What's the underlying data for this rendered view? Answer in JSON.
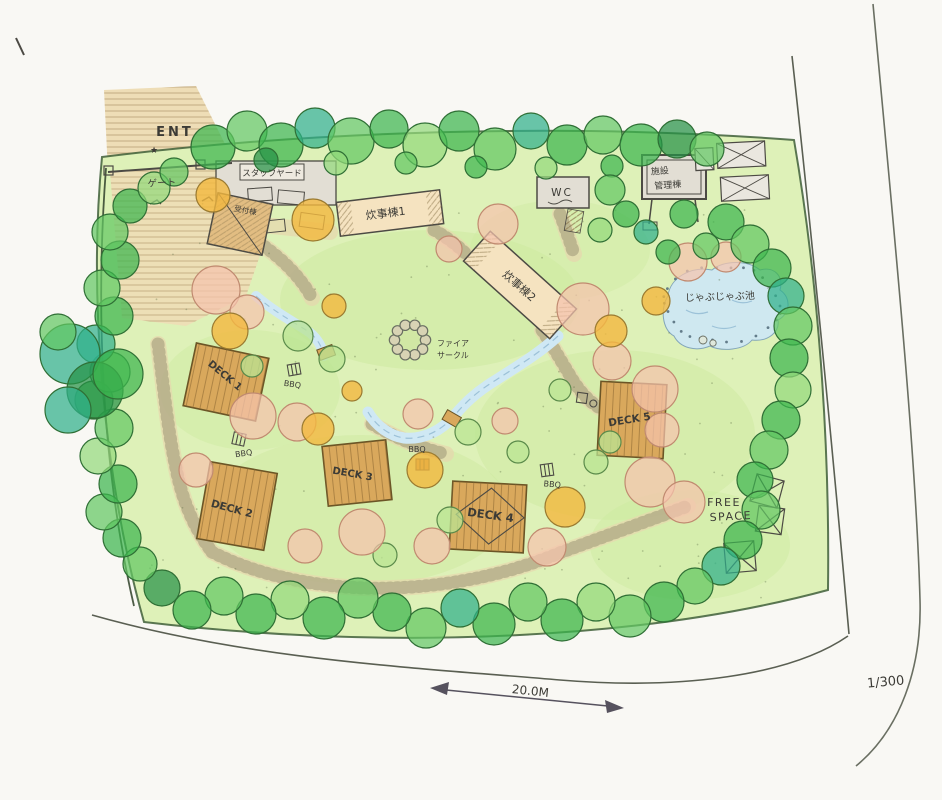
{
  "palette": {
    "paper": "#f9f8f4",
    "lawn": "#def1b8",
    "lawn_wash": "#cdeaa0",
    "tree_green": "#3cb54e",
    "tree_green_mid": "#63c863",
    "tree_green_light": "#93d97c",
    "tree_teal": "#2fb08b",
    "tree_green_dark": "#259147",
    "tree_orange": "#f3b83e",
    "tree_pink": "#f5c3ad",
    "deck_wood": "#d9a85c",
    "building_beige": "#f5e3c0",
    "building_gray": "#e2ded4",
    "reception_tan": "#e2bd82",
    "road_tan": "#eeddb6",
    "water": "#cfe8f4",
    "pen": "#4c4a44",
    "ink_purple": "#8a7fae"
  },
  "entrance": {
    "label": "ENT",
    "gate": "ゲート"
  },
  "buildings": {
    "staff_yard": "スタッフヤード",
    "reception": "受付棟",
    "cooking_1": "炊事棟1",
    "cooking_2": "炊事棟2",
    "wc": "WC",
    "facility_mgmt_line1": "施設",
    "facility_mgmt_line2": "管理棟"
  },
  "features": {
    "pond": "じゃぶじゃぶ池",
    "fire_circle_line1": "ファイア",
    "fire_circle_line2": "サークル",
    "free_space_line1": "FREE",
    "free_space_line2": "SPACE"
  },
  "decks": [
    "DECK 1",
    "DECK 2",
    "DECK 3",
    "DECK 4",
    "DECK 5"
  ],
  "bbq_label": "BBQ",
  "scale": {
    "length": "20.0M",
    "ratio": "1/300"
  }
}
